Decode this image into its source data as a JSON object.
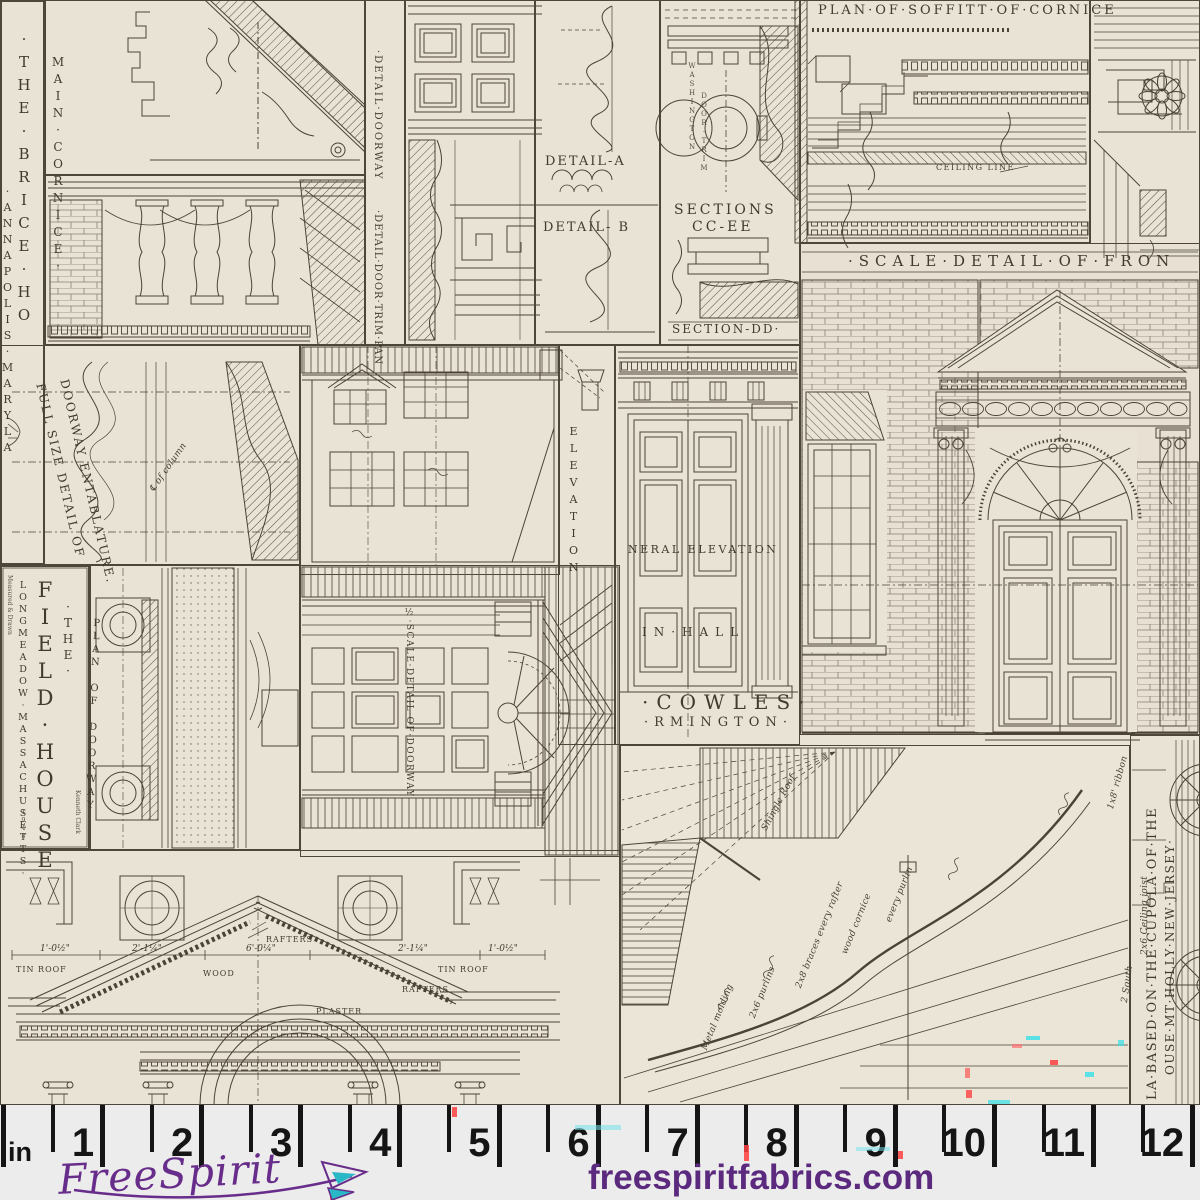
{
  "fabric": {
    "colors": {
      "background": "#e9e3d6",
      "ink": "#4a4336"
    },
    "labels": {
      "brice_line1": "·THE·BRICE·HO",
      "brice_line2": "·ANNAPOLIS·MARYLA",
      "main_cornice": "MAIN·CORNICE·",
      "detail_doorway": "·DETAIL·DOORWAY",
      "detail_door_trim": "·DETAIL·DOOR·TRIM·PAN",
      "detail_a": "DETAIL-A",
      "detail_b": "DETAIL- B",
      "washington": "WASHINGTON",
      "door_trim": "DOOR·TRIM",
      "sections": "SECTIONS",
      "cc_ee": "CC-EE",
      "section_dd": "SECTION-DD·",
      "plan_soffitt": "PLAN·OF·SOFFITT·OF·CORNICE",
      "ceiling_line": "CEILING LINE",
      "scale_front": "·SCALE·DETAIL·OF·FRON",
      "elevation": "ELEVATION",
      "general_elevation": "NERAL ELEVATION",
      "in_hall": "IN·HALL",
      "cowles": "·COWLES·",
      "farmington": "·RMINGTON·",
      "full_size_1": "FULL SIZE DETAIL OF",
      "full_size_2": "DOORWAY ENTABLATURE.",
      "the": "·THE·",
      "field_house": "FIELD·HOUSE",
      "longmeadow": "LONGMEADOW·MASSACHUSETTS·",
      "measured": "Measured & Drawn",
      "year": "1948",
      "kenneth": "Kenneth Clark",
      "plan_doorway": "PLAN OF DOORWAY",
      "scale_doorway": "½·SCALE·DETAIL·OF·DOORWAY",
      "cupola_1": "LA·BASED·ON·THE·CUPOLA·OF·THE",
      "cupola_2": "OUSE·MT·HOLLY·NEW·JERSEY·",
      "tin_roof": "TIN ROOF",
      "rafters": "RAFTERS",
      "wood": "WOOD",
      "plaster": "PLASTER"
    },
    "hand_notes": [
      "Shingle Roof",
      "Metal molding",
      "2x6 purlins",
      "2x8 braces every rafter",
      "wood cornice",
      "every purlin",
      "2x6 Ceiling joist",
      "1x8' ribbon",
      "2 South",
      "℄ of column"
    ],
    "dimensions": [
      "1'-0½\"",
      "2'-1¼\"",
      "6'-0¼\"",
      "2'-1¼\"",
      "1'-0½\""
    ]
  },
  "ruler": {
    "unit": "in",
    "numbers": [
      "1",
      "2",
      "3",
      "4",
      "5",
      "6",
      "7",
      "8",
      "9",
      "10",
      "11",
      "12"
    ]
  },
  "branding": {
    "logo": "FreeSpirit",
    "website": "freespiritfabrics.com",
    "purple": "#5e2b84",
    "teal": "#2ab7c6"
  }
}
